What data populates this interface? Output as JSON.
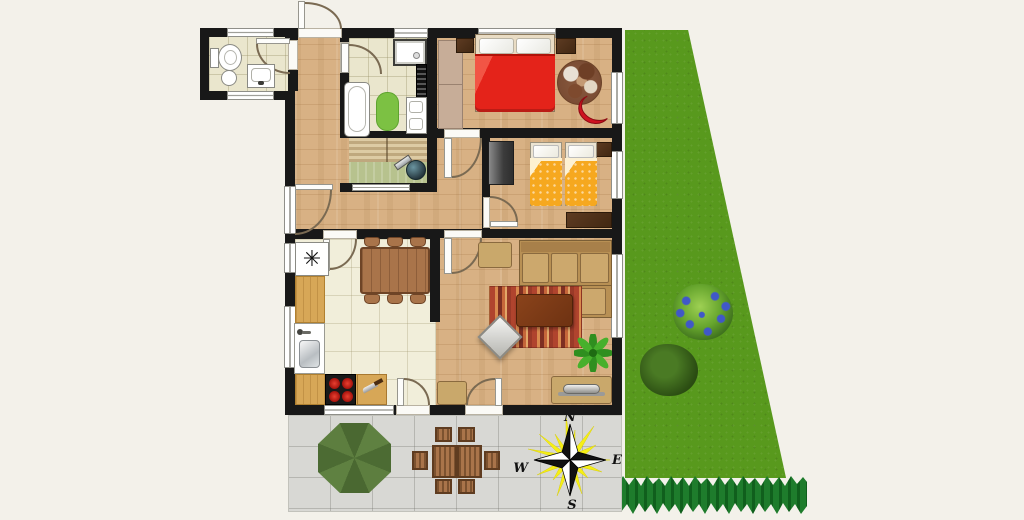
{
  "compass": {
    "north": "N",
    "east": "E",
    "south": "S",
    "west": "W"
  },
  "kitchen": {
    "freezer_symbol": "✳"
  },
  "palette": {
    "background": "#f3f1ea",
    "wall": "#181818",
    "wood_floor": "#d8b184",
    "bath_tile": "#eae6cd",
    "kitchen_tile": "#f1eeda",
    "patio_tile": "#d8d8d4",
    "garden_grass": "#58991d",
    "hedge": "#1e7c2c",
    "double_bed": "#e4231a",
    "single_bed": "#f6a81f",
    "sofa": "#c8a263",
    "living_rug": "#b0442e",
    "bath_mat": "#7cc143",
    "armchair": "#cf1220",
    "parasol": "#5d7c3c",
    "compass_burst": "#f6ef15"
  },
  "icons": {
    "freezer": "asterisk-snowflake",
    "compass_rose": "four-point-star-with-sunburst",
    "toilet": "css-shape",
    "bidet": "css-shape",
    "bathtub": "css-shape",
    "shower": "css-shape",
    "vanity_sinks": "css-shape",
    "towel_radiator": "css-shape",
    "stove": "css-shape",
    "sink": "css-shape",
    "cutting_board": "css-shape",
    "double_bed": "css-shape",
    "single_bed": "css-shape",
    "wardrobe": "css-shape",
    "sofa": "css-shape",
    "coffee_table": "css-shape",
    "rug": "css-shape",
    "plant": "svg-shape",
    "parasol": "octagon",
    "bush": "css-shape",
    "hedge": "css-shape"
  }
}
